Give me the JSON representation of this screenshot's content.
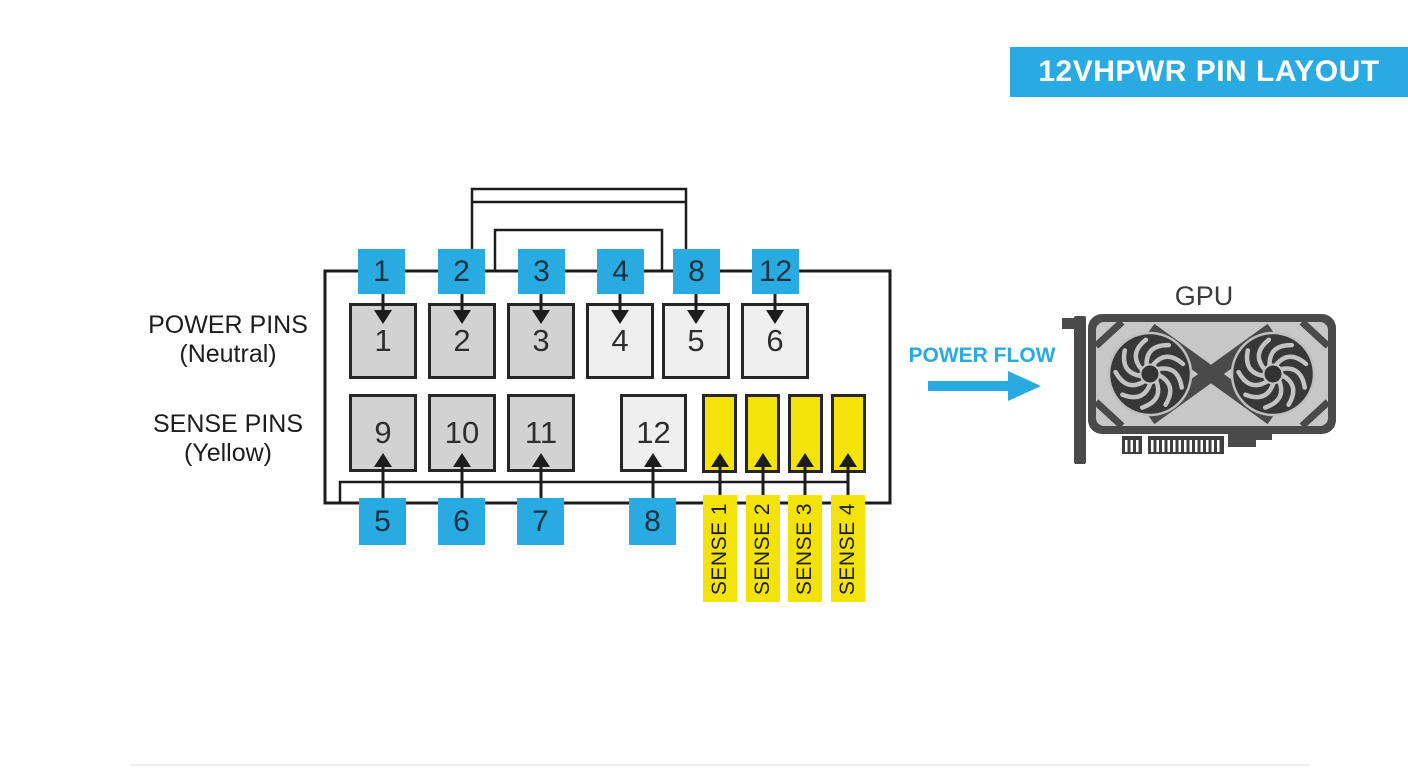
{
  "title": "12VHPWR PIN LAYOUT",
  "legend": {
    "power": {
      "line1": "POWER PINS",
      "line2": "(Neutral)"
    },
    "sense": {
      "line1": "SENSE PINS",
      "line2": "(Yellow)"
    }
  },
  "connector": {
    "top_wire_labels": [
      "1",
      "2",
      "3",
      "4",
      "8",
      "12"
    ],
    "top_row_pins": [
      "1",
      "2",
      "3",
      "4",
      "5",
      "6"
    ],
    "bottom_row_pins": [
      "9",
      "10",
      "11",
      "12"
    ],
    "bottom_wire_labels": [
      "5",
      "6",
      "7",
      "8"
    ],
    "sense_pin_labels": [
      "SENSE 1",
      "SENSE 2",
      "SENSE 3",
      "SENSE 4"
    ]
  },
  "flow": {
    "label": "POWER FLOW"
  },
  "gpu": {
    "label": "GPU"
  },
  "colors": {
    "accent_cyan": "#29abe2",
    "sense_yellow": "#f4e20b",
    "pin_gray_dark": "#d2d2d2",
    "pin_gray_light": "#efefef",
    "line_dark": "#1c1c1c",
    "gpu_body": "#4a4a4a",
    "gpu_shroud": "#c7c7c7"
  }
}
